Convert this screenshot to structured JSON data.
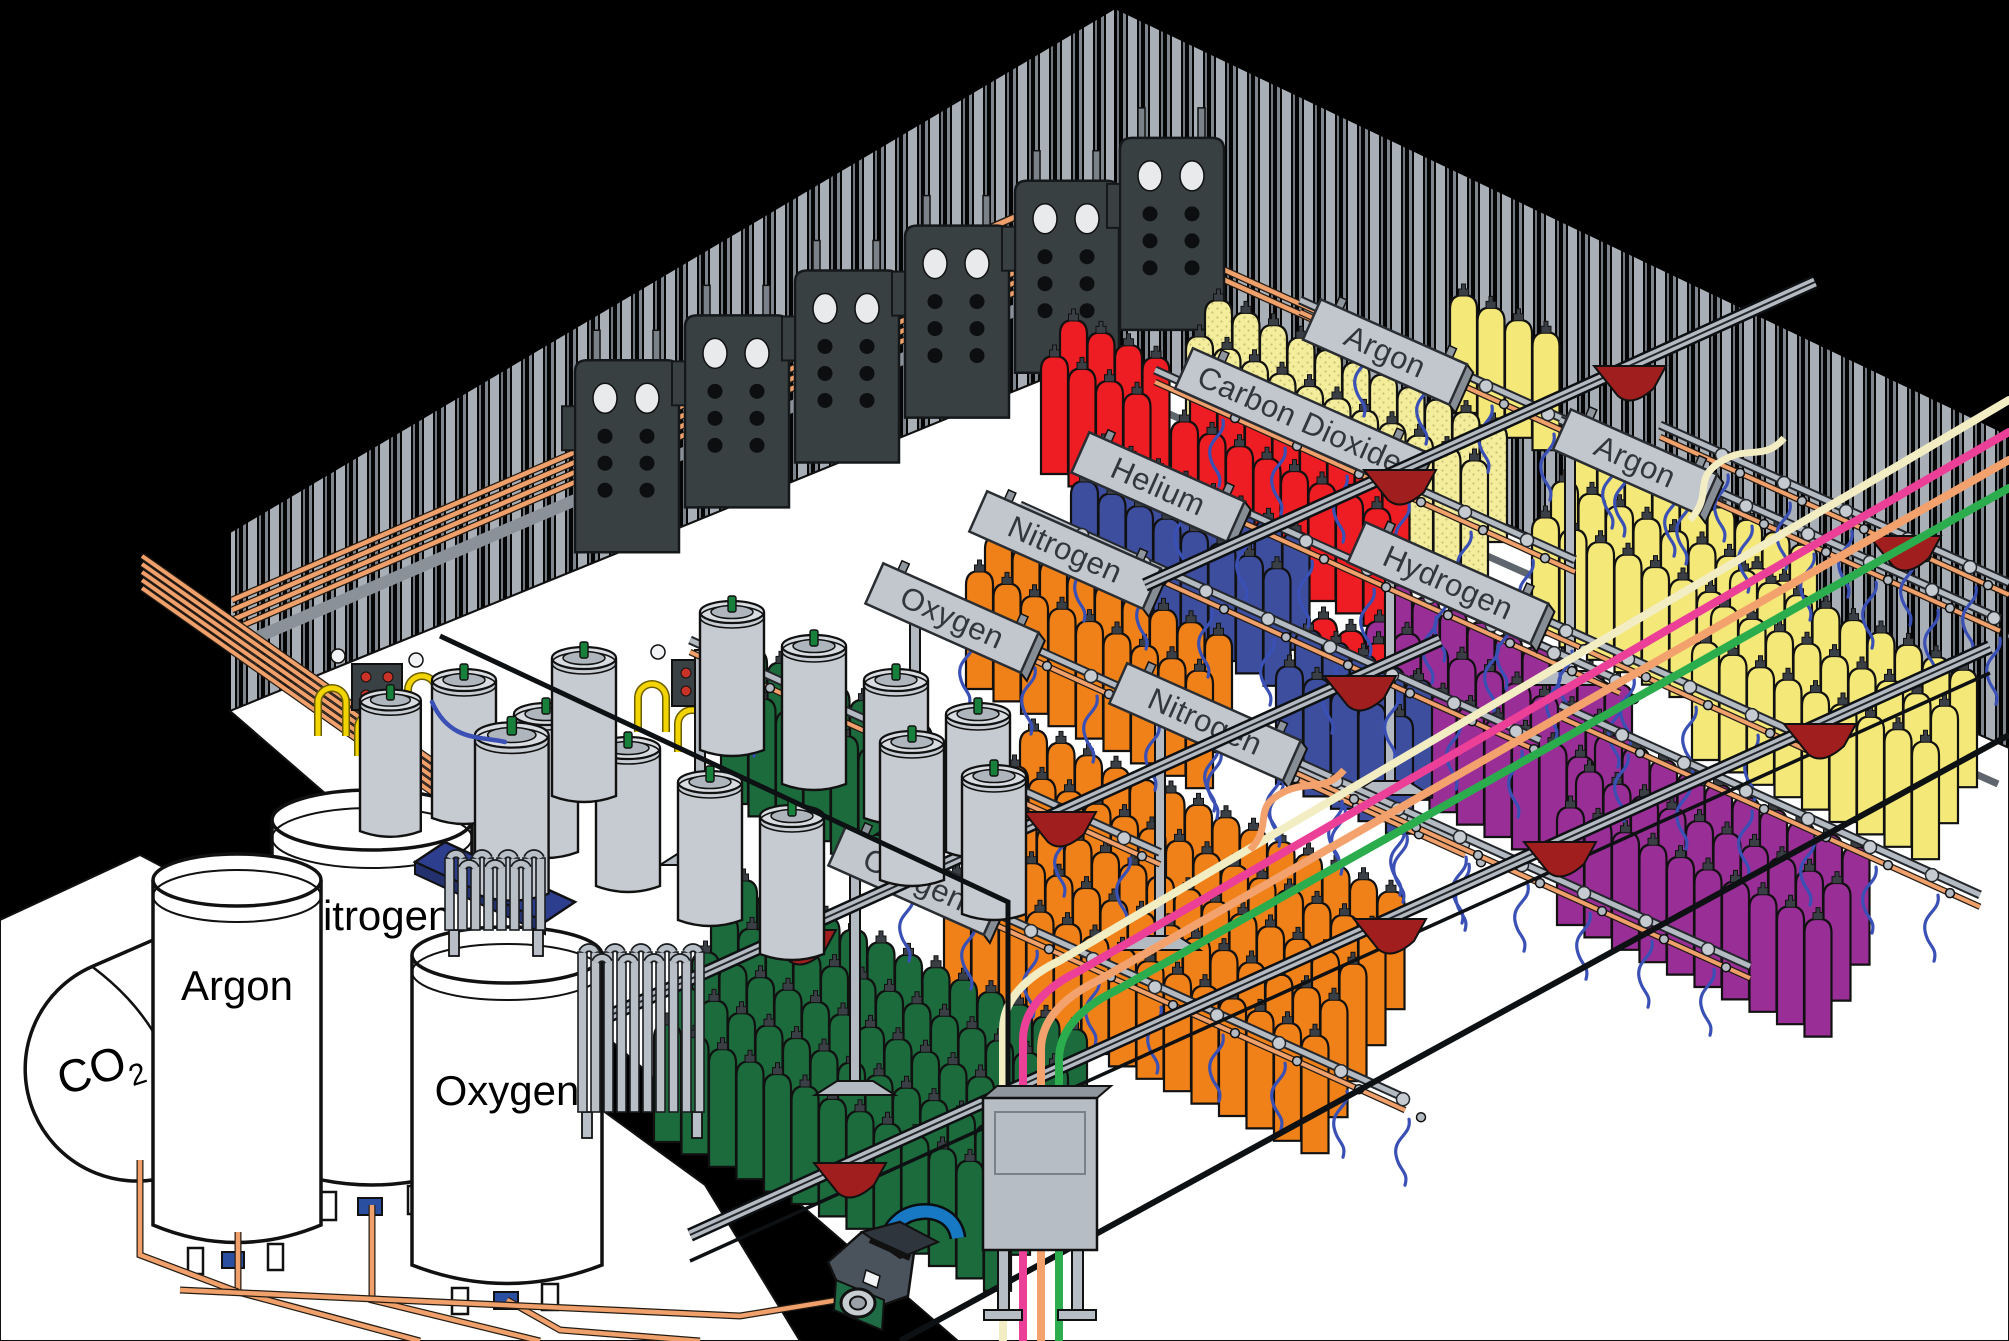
{
  "scene": {
    "type": "isometric cutaway illustration",
    "subject": "Industrial gas cylinder filling plant: bulk cryogenic storage tanks outside, copper supply piping, overhead filling rails with labeled gas stations and color-coded cylinder banks"
  },
  "signs": [
    {
      "id": "oxygen-a",
      "label": "Oxygen"
    },
    {
      "id": "nitrogen-a",
      "label": "Nitrogen"
    },
    {
      "id": "helium",
      "label": "Helium"
    },
    {
      "id": "carbon-dioxide",
      "label": "Carbon Dioxide"
    },
    {
      "id": "argon-back",
      "label": "Argon"
    },
    {
      "id": "hydrogen",
      "label": "Hydrogen"
    },
    {
      "id": "argon-right",
      "label": "Argon"
    },
    {
      "id": "nitrogen-center",
      "label": "Nitrogen"
    },
    {
      "id": "oxygen-front",
      "label": "Oxygen"
    }
  ],
  "tanks": [
    {
      "id": "co2",
      "label": "CO2",
      "label_main": "CO",
      "label_sub": "2",
      "form": "horizontal capsule tank"
    },
    {
      "id": "argon",
      "label": "Argon",
      "form": "vertical tank"
    },
    {
      "id": "nitrogen",
      "label": "Nitrogen",
      "form": "vertical tank"
    },
    {
      "id": "oxygen",
      "label": "Oxygen",
      "form": "vertical tank"
    }
  ],
  "cylinder_banks": [
    {
      "color_name": "dark_green",
      "hex": "#1C6B3C",
      "location": "front-left banks by the Oxygen signs"
    },
    {
      "color_name": "orange",
      "hex": "#F08118",
      "location": "center banks by the Oxygen / Nitrogen rows"
    },
    {
      "color_name": "dark_blue",
      "hex": "#3D4E9E",
      "location": "rows behind the Nitrogen signs"
    },
    {
      "color_name": "red",
      "hex": "#EE1C23",
      "location": "rows by the Helium sign"
    },
    {
      "color_name": "pale_yellow_dotted",
      "hex": "#F4EE9C",
      "location": "row by the Carbon Dioxide sign"
    },
    {
      "color_name": "yellow",
      "hex": "#F3E878",
      "location": "right-side banks by the Argon signs"
    },
    {
      "color_name": "purple",
      "hex": "#9A2E97",
      "location": "right-side banks by the Hydrogen sign"
    },
    {
      "color_name": "gray",
      "hex": "#C6CBD1",
      "location": "cryogenic liquid dewars near the storage tanks"
    }
  ],
  "equipment": [
    "corrugated warehouse walls",
    "white plant floor",
    "copper supply piping",
    "wall manifold panels with gauges",
    "overhead filling rails with blue pigtail hoses",
    "overhead crane beams with red trolley hoists",
    "bulk cryogenic storage tanks",
    "ambient-air vaporizers",
    "liquid dewar cylinders on blue pallet",
    "transfer pump",
    "filling control cabinet",
    "colored gas supply hoses"
  ],
  "palette": {
    "background": "#000000",
    "floor": "#FFFFFF",
    "wall_stripe": "#A9AFB7",
    "wall_stripe_dark": "#7E858D",
    "copper_pipe": "#EFA06B",
    "rail_light": "#B4BAC2",
    "rail_dark": "#23272B",
    "sign_plate": "#C2C6CD",
    "sign_text": "#33373D",
    "trolley_red": "#A01E1E",
    "pigtail_hose_blue": "#3A50B5",
    "fill_hose_yellow": "#F2D400",
    "pump_blue": "#1779C4",
    "pump_green": "#1F6B45",
    "pallet_blue": "#2E3E8F",
    "dewar_gray": "#C6CBD1",
    "panel_dark": "#394042",
    "cylinders": {
      "green": "#1C6B3C",
      "orange": "#F08118",
      "blue": "#3D4E9E",
      "red": "#EE1C23",
      "pale_yellow": "#F4EE9C",
      "yellow": "#F3E878",
      "purple": "#9A2E97",
      "gray": "#C6CBD1"
    },
    "supply_lines": {
      "cream": "#F3EDC4",
      "pink": "#EC3F97",
      "salmon": "#F3A26D",
      "green": "#2BAD4E"
    }
  }
}
